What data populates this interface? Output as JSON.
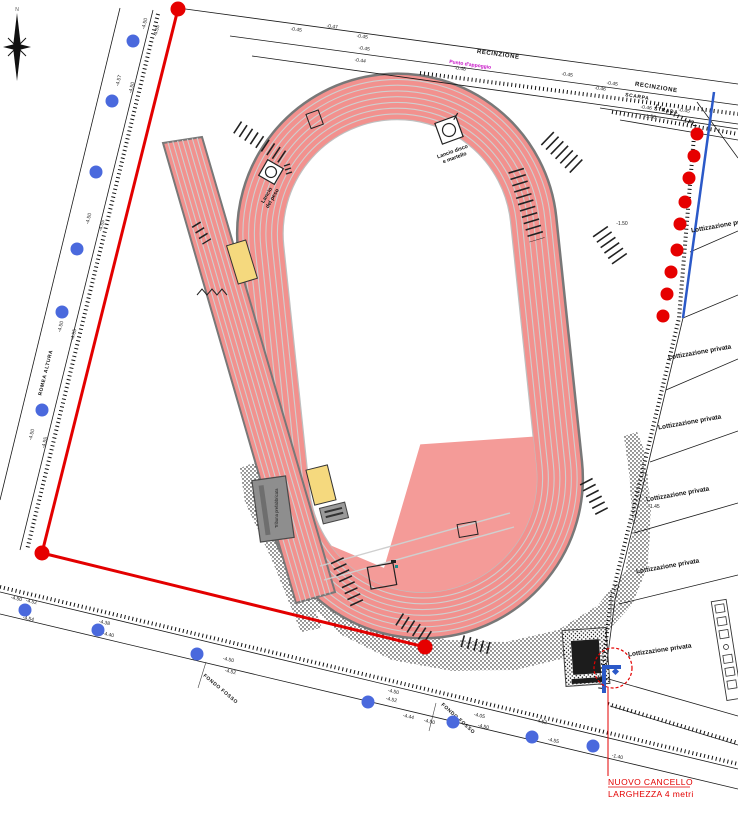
{
  "compass": {
    "label": "N"
  },
  "roads": {
    "left_name": "ROMEA ALTURA",
    "top_fence": "RECINZIONE",
    "top_fence2": "RECINZIONE",
    "scarpa": "SCARPA",
    "strada": "STRADA",
    "canal": "Punto d'appoggio",
    "fosso": "FONDO FOSSO"
  },
  "track": {
    "disco1": "Lancio disco",
    "disco2": "e martello",
    "peso1": "Lancio",
    "peso2": "del peso",
    "tribuna": "Tribuna prefabbricata"
  },
  "gate": {
    "line1": "NUOVO CANCELLO",
    "line2": "LARGHEZZA 4 metri"
  },
  "parcels": {
    "label": "Lottizzazione privata"
  },
  "elevations": [
    {
      "x": 146,
      "y": 24,
      "r": -76,
      "t": "-4.50"
    },
    {
      "x": 158,
      "y": 31,
      "r": -76,
      "t": "-4.55"
    },
    {
      "x": 120,
      "y": 81,
      "r": -76,
      "t": "-4.57"
    },
    {
      "x": 133,
      "y": 88,
      "r": -76,
      "t": "-4.50"
    },
    {
      "x": 90,
      "y": 219,
      "r": -76,
      "t": "-4.50"
    },
    {
      "x": 103,
      "y": 226,
      "r": -76,
      "t": "-4.55"
    },
    {
      "x": 62,
      "y": 327,
      "r": -76,
      "t": "-4.50"
    },
    {
      "x": 75,
      "y": 335,
      "r": -76,
      "t": "-4.55"
    },
    {
      "x": 33,
      "y": 435,
      "r": -76,
      "t": "-4.50"
    },
    {
      "x": 46,
      "y": 443,
      "r": -76,
      "t": "-4.55"
    },
    {
      "x": 296,
      "y": 31,
      "r": 8,
      "t": "-0.45"
    },
    {
      "x": 332,
      "y": 28,
      "r": 8,
      "t": "-0.47"
    },
    {
      "x": 362,
      "y": 38,
      "r": 8,
      "t": "-0.45"
    },
    {
      "x": 364,
      "y": 50,
      "r": 8,
      "t": "-0.45"
    },
    {
      "x": 360,
      "y": 62,
      "r": 8,
      "t": "-0.44"
    },
    {
      "x": 460,
      "y": 70,
      "r": 8,
      "t": "-0.46"
    },
    {
      "x": 567,
      "y": 76,
      "r": 8,
      "t": "-0.45"
    },
    {
      "x": 612,
      "y": 85,
      "r": 8,
      "t": "-0.45"
    },
    {
      "x": 600,
      "y": 90,
      "r": 8,
      "t": "-0.46"
    },
    {
      "x": 646,
      "y": 109,
      "r": 8,
      "t": "-0.46"
    },
    {
      "x": 684,
      "y": 112,
      "r": 8,
      "t": "-0.45"
    },
    {
      "x": 650,
      "y": 118,
      "r": 8,
      "t": "-1.50"
    },
    {
      "x": 688,
      "y": 123,
      "r": 8,
      "t": "-1.45"
    },
    {
      "x": 622,
      "y": 225,
      "r": 0,
      "t": "-1.50"
    },
    {
      "x": 654,
      "y": 508,
      "r": 0,
      "t": "-1.45"
    },
    {
      "x": 16,
      "y": 600,
      "r": 13,
      "t": "-4.50"
    },
    {
      "x": 31,
      "y": 603,
      "r": 13,
      "t": "-4.52"
    },
    {
      "x": 28,
      "y": 620,
      "r": 13,
      "t": "-4.54"
    },
    {
      "x": 104,
      "y": 624,
      "r": 13,
      "t": "-4.38"
    },
    {
      "x": 108,
      "y": 636,
      "r": 13,
      "t": "-4.40"
    },
    {
      "x": 228,
      "y": 661,
      "r": 13,
      "t": "-4.50"
    },
    {
      "x": 230,
      "y": 673,
      "r": 13,
      "t": "-4.52"
    },
    {
      "x": 393,
      "y": 693,
      "r": 13,
      "t": "-4.50"
    },
    {
      "x": 391,
      "y": 701,
      "r": 13,
      "t": "-4.52"
    },
    {
      "x": 408,
      "y": 718,
      "r": 13,
      "t": "-4.44"
    },
    {
      "x": 429,
      "y": 723,
      "r": 13,
      "t": "-4.50"
    },
    {
      "x": 479,
      "y": 717,
      "r": 13,
      "t": "-4.05"
    },
    {
      "x": 483,
      "y": 728,
      "r": 13,
      "t": "-4.50"
    },
    {
      "x": 541,
      "y": 723,
      "r": 13,
      "t": "-4.52"
    },
    {
      "x": 553,
      "y": 742,
      "r": 13,
      "t": "-4.55"
    },
    {
      "x": 617,
      "y": 758,
      "r": 13,
      "t": "-1.40"
    }
  ],
  "markers": {
    "blue": [
      [
        133,
        41
      ],
      [
        112,
        101
      ],
      [
        96,
        172
      ],
      [
        77,
        249
      ],
      [
        62,
        312
      ],
      [
        42,
        410
      ],
      [
        25,
        610
      ],
      [
        98,
        630
      ],
      [
        197,
        654
      ],
      [
        368,
        702
      ],
      [
        453,
        722
      ],
      [
        532,
        737
      ],
      [
        593,
        746
      ]
    ],
    "red_fence": [
      [
        697,
        134
      ],
      [
        694,
        156
      ],
      [
        689,
        178
      ],
      [
        685,
        202
      ],
      [
        680,
        224
      ],
      [
        677,
        250
      ],
      [
        671,
        272
      ],
      [
        667,
        294
      ],
      [
        663,
        316
      ]
    ],
    "red_boundary": [
      [
        178,
        9
      ],
      [
        42,
        553
      ],
      [
        425,
        647
      ]
    ]
  },
  "colors": {
    "track_salmon": "#F2918E",
    "field_salmon": "#F49B98",
    "lane_line": "#CFCFCF",
    "curb_gray": "#787878",
    "boundary_red": "#E30000",
    "marker_blue": "#4A69DD",
    "line_blue": "#2B59C8",
    "building_yellow": "#F5D97E",
    "grandstand_gray": "#8E8E8E",
    "label_magenta": "#C713C7"
  }
}
